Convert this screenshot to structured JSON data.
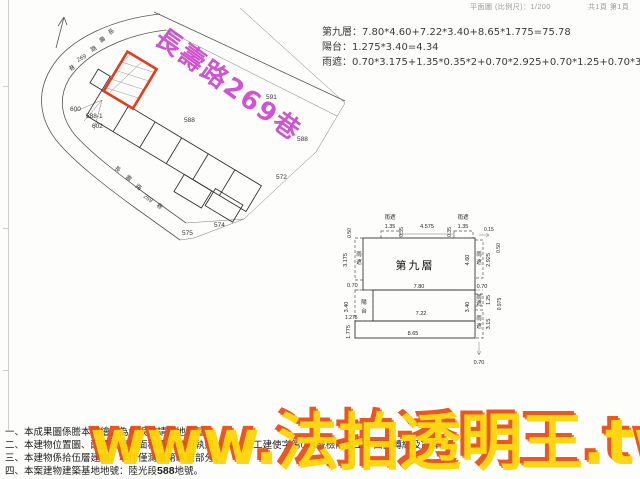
{
  "header": {
    "scale_text": "平面圖 (比例尺)：1/200",
    "page_text": "共1頁 第1頁"
  },
  "calculations": {
    "line1": "第九層：7.80*4.60+7.22*3.40+8.65*1.775=75.78",
    "line2": "陽台：1.275*3.40=4.34",
    "line3": "雨遮：0.70*3.175+1.35*0.35*2+0.70*2.925+0.70*1.25+0.70*3.15=8.30"
  },
  "site_plan": {
    "road_name": "長壽路269巷",
    "labels": [
      {
        "t": "591"
      },
      {
        "t": "588"
      },
      {
        "t": "588"
      },
      {
        "t": "572"
      },
      {
        "t": "574"
      },
      {
        "t": "575"
      },
      {
        "t": "600"
      },
      {
        "t": "588-1"
      },
      {
        "t": "602"
      },
      {
        "t": "長"
      },
      {
        "t": "壽"
      },
      {
        "t": "路"
      },
      {
        "t": "269"
      },
      {
        "t": "巷"
      },
      {
        "t": "長"
      },
      {
        "t": "壽"
      },
      {
        "t": "路"
      },
      {
        "t": "269"
      },
      {
        "t": "巷"
      }
    ]
  },
  "floor_plan": {
    "labels": [
      {
        "t": "第九層"
      },
      {
        "t": "雨遮"
      },
      {
        "t": "1.35"
      },
      {
        "t": "0.35"
      },
      {
        "t": "4.575"
      },
      {
        "t": "0.35"
      },
      {
        "t": "雨遮"
      },
      {
        "t": "1.35"
      },
      {
        "t": "0.15"
      },
      {
        "t": "0.50"
      },
      {
        "t": "0.50"
      },
      {
        "t": "3.175"
      },
      {
        "t": "雨"
      },
      {
        "t": "遮"
      },
      {
        "t": "0.70"
      },
      {
        "t": "7.80"
      },
      {
        "t": "0.70"
      },
      {
        "t": "4.60"
      },
      {
        "t": "雨"
      },
      {
        "t": "遮"
      },
      {
        "t": "2.925"
      },
      {
        "t": "陽"
      },
      {
        "t": "台"
      },
      {
        "t": "3.40"
      },
      {
        "t": "1.275"
      },
      {
        "t": "1.775"
      },
      {
        "t": "7.22"
      },
      {
        "t": "8.65"
      },
      {
        "t": "雨"
      },
      {
        "t": "遮"
      },
      {
        "t": "1.25"
      },
      {
        "t": "0.975"
      },
      {
        "t": "3.40"
      },
      {
        "t": "雨"
      },
      {
        "t": "遮"
      },
      {
        "t": "3.15"
      },
      {
        "t": "0.70"
      }
    ]
  },
  "notes": {
    "n1": "一、本成果圖係謄本轉繪，為免誤差請實地測量。",
    "n2": "二、本建物位置圖、配置及建物面積係依使用執照（84）府工建使字第044號檢附竣工平面圖轉繪及計算。",
    "n3": "三、本建物係拾伍層建物，本件僅測量第玖層部分。",
    "n4_pre": "四、本案建物建築基地地號：陸光段",
    "n4_num": "588",
    "n4_post": "地號。"
  },
  "watermark": {
    "text": "www.法拍透明王.tw"
  },
  "colors": {
    "road_label": "#c837c8",
    "parcel_outline": "#e8391d",
    "watermark_fill": "#ffd400",
    "watermark_shadow": "#e84b12"
  }
}
